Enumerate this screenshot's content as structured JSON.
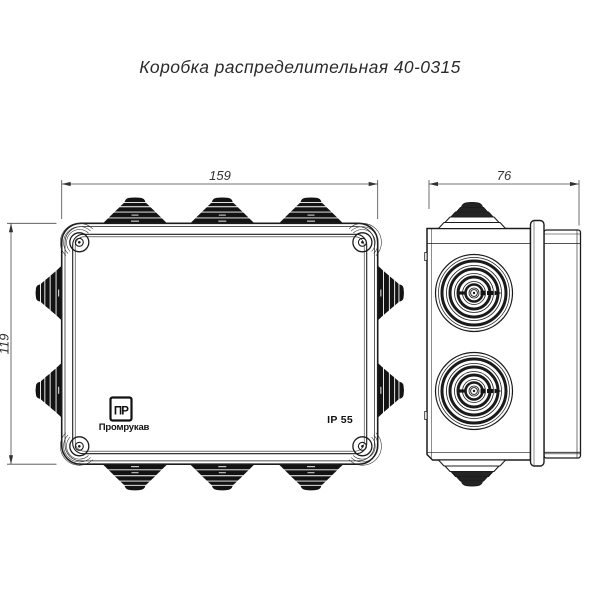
{
  "drawing": {
    "title": "Коробка распределительная 40-0315",
    "front_view": {
      "dim_width": "159",
      "dim_height": "119"
    },
    "side_view": {
      "dim_depth": "76"
    },
    "markings": {
      "logo_glyph": "ПР",
      "brand": "Промрукав",
      "ip_rating": "IP 55"
    },
    "colors": {
      "line": "#1c1c1c",
      "dimension": "#4a4a4a",
      "gland_fill": "#131313",
      "background": "#ffffff"
    }
  }
}
